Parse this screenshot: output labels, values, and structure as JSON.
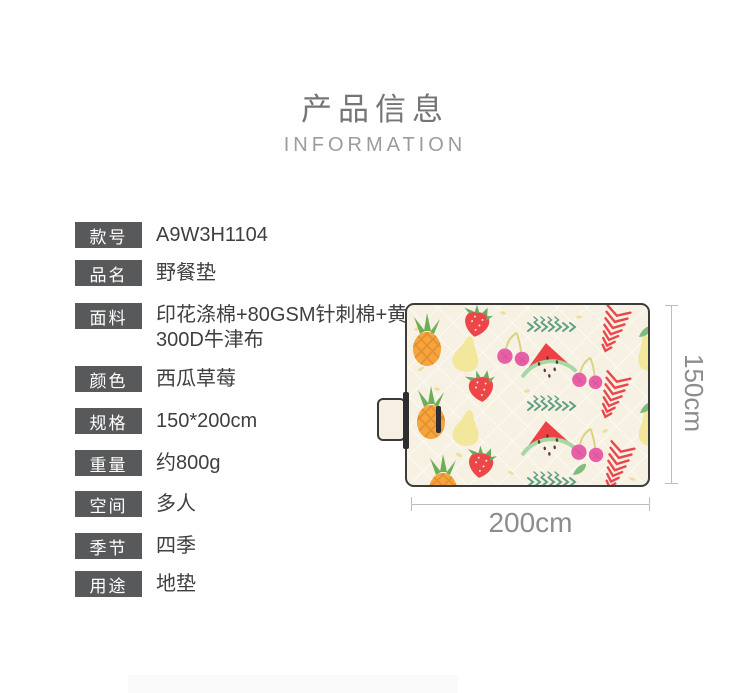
{
  "header": {
    "title": "产品信息",
    "subtitle": "INFORMATION"
  },
  "specs": [
    {
      "label": "款号",
      "value": "A9W3H1104"
    },
    {
      "label": "品名",
      "value": "野餐垫"
    },
    {
      "label": "面料",
      "value": "印花涤棉+80GSM针刺棉+黄色300D牛津布"
    },
    {
      "label": "颜色",
      "value": "西瓜草莓"
    },
    {
      "label": "规格",
      "value": "150*200cm"
    },
    {
      "label": "重量",
      "value": "约800g"
    },
    {
      "label": "空间",
      "value": "多人"
    },
    {
      "label": "季节",
      "value": "四季"
    },
    {
      "label": "用途",
      "value": "地垫"
    }
  ],
  "figure": {
    "width_label": "200cm",
    "height_label": "150cm",
    "pattern_fruits": [
      "watermelon",
      "strawberry",
      "pineapple",
      "pear",
      "cherries"
    ],
    "colors": {
      "mat_background": "#f7f1e3",
      "mat_border": "#3c3c3a",
      "watermelon_red": "#ee4146",
      "rind_green": "#a6d7a4",
      "strawberry_red": "#ec4648",
      "pineapple_orange": "#f6a43e",
      "pear_yellow": "#f3e79b",
      "cherry_pink": "#e75fa4",
      "chevron_green": "#5e9f82",
      "fern_red": "#e8474b",
      "label_chip_gray": "#58595b",
      "dimension_gray": "#8d8d8d"
    }
  }
}
